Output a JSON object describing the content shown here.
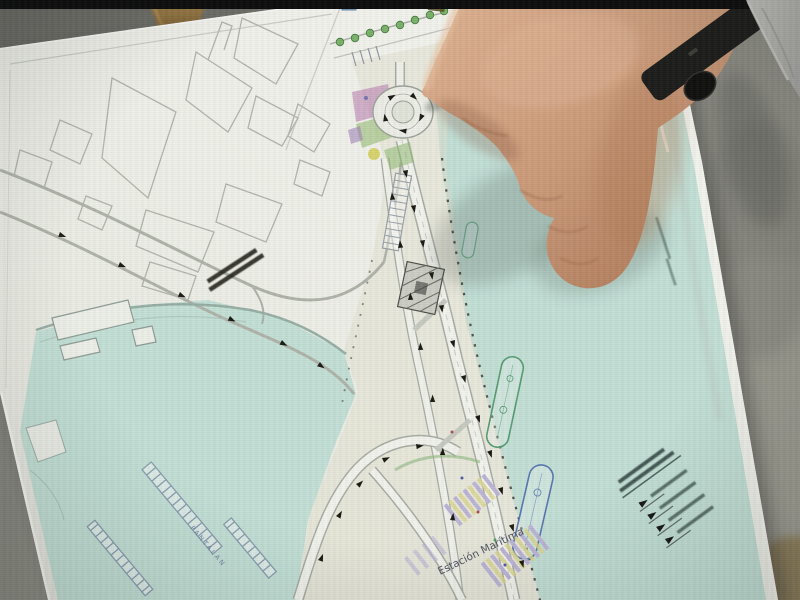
{
  "map": {
    "labels": {
      "estacion_maritima": "Estación Marítima",
      "pantalan": "PANTALAN"
    },
    "legend": {
      "title_line_count": 2,
      "entry_count": 4,
      "note": "legend text too small to be legible in photo"
    }
  },
  "colors": {
    "water": "#c3e2d8",
    "paper": "#f2f3ec",
    "concrete_dark": "#72726b",
    "concrete_light": "#9a998f",
    "letterbox": "#0a0a0a",
    "skin_mid": "#d09a76",
    "watch_band": "#191917",
    "sleeve": "#b3b3af",
    "easel_wood": "#8f6f3a",
    "parcel_pink": "#c690bc",
    "parcel_green": "#9cc27a",
    "parcel_yellow": "#d4ce44",
    "parking_lavender": "#beb6da",
    "parking_yellow": "#ded888",
    "ship_green": "#4f9e6e",
    "ship_blue": "#5577b5"
  }
}
